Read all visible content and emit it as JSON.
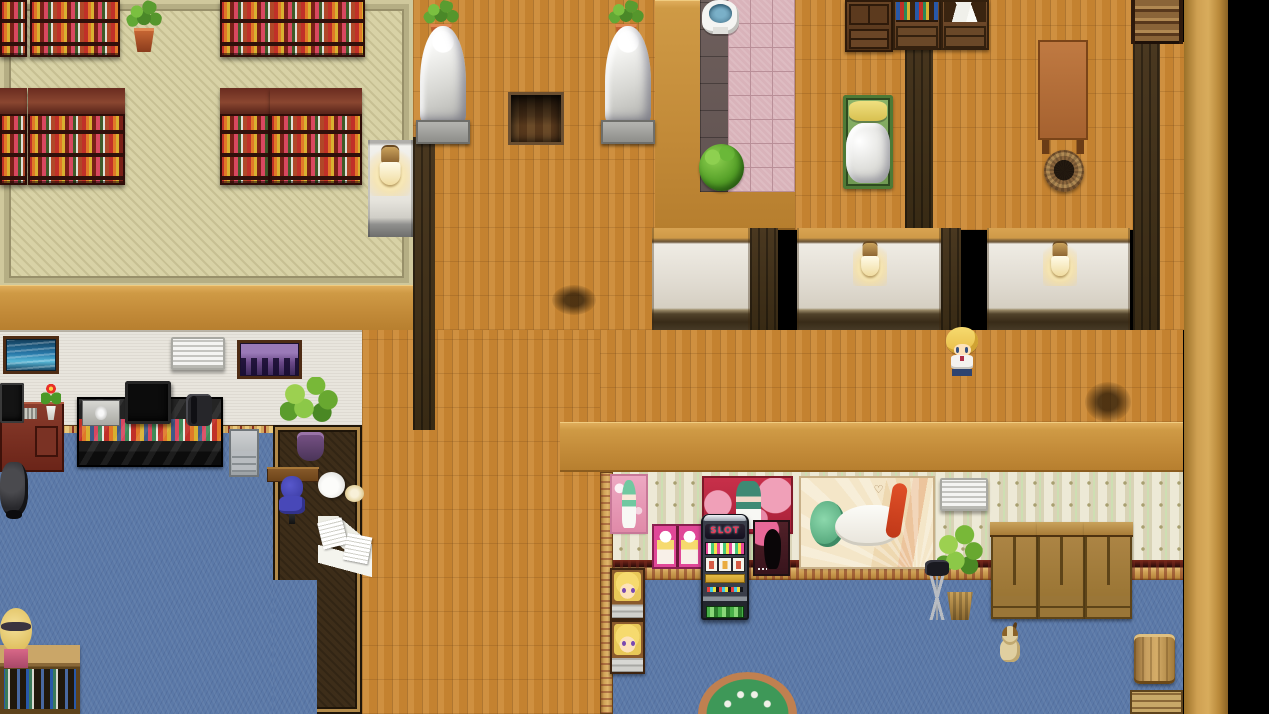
{
  "meta": {
    "width": 1269,
    "height": 714,
    "scene": "rpg-interior-map"
  },
  "labels": {
    "slot_machine": "SLOT",
    "love_poster": "Love"
  },
  "palette": {
    "wood_floor": "#c8883a",
    "tatami": "#d8d2a6",
    "tan_wall": "#c9953f",
    "dark_wall_shadow": "#3f2e1a",
    "office_wall": "#e8e5dd",
    "carpet_blue": "#5b79a8",
    "wallpaper": "#e6e1c8",
    "gold_trim": "#cfa156",
    "lounge_floor": "#3d2d19",
    "pink_path": "#d9b3ba",
    "dark_stone": "#6e5f5c",
    "statue_white": "#e8e8e4",
    "poster_red": "#c8304a",
    "poster_pink": "#e04898",
    "slot_text_red": "#f03858",
    "void": "#000000"
  },
  "scene": {
    "regions": [
      {
        "name": "library-floor",
        "type": "tatami",
        "rect": [
          0,
          0,
          413,
          287
        ],
        "interactable": false
      },
      {
        "name": "library-south-wall",
        "type": "tanwall",
        "rect": [
          0,
          285,
          413,
          47
        ],
        "interactable": false
      },
      {
        "name": "office-wall",
        "type": "officewall",
        "rect": [
          0,
          330,
          362,
          95
        ],
        "interactable": false
      },
      {
        "name": "office-wall-trim",
        "type": "bordertrim",
        "rect": [
          0,
          425,
          273,
          9
        ],
        "interactable": false
      },
      {
        "name": "office-carpet",
        "type": "carpet",
        "rect": [
          0,
          433,
          273,
          281
        ],
        "interactable": false
      },
      {
        "name": "lounge-floor",
        "type": "brownfloor",
        "rect": [
          273,
          425,
          89,
          289
        ],
        "interactable": false
      },
      {
        "name": "office-carpet-notch",
        "type": "carpet",
        "rect": [
          273,
          580,
          44,
          134
        ],
        "interactable": false
      },
      {
        "name": "hall-floor-north",
        "type": "wood",
        "rect": [
          413,
          0,
          242,
          330
        ],
        "interactable": false
      },
      {
        "name": "hall-floor-south",
        "type": "wood",
        "rect": [
          362,
          330,
          238,
          384
        ],
        "interactable": false
      },
      {
        "name": "hall-floor-band",
        "type": "wood",
        "rect": [
          600,
          330,
          583,
          92
        ],
        "interactable": false
      },
      {
        "name": "bedroom-floor",
        "type": "wood",
        "rect": [
          795,
          0,
          388,
          230
        ],
        "interactable": false
      },
      {
        "name": "hall-floor-east",
        "type": "wood",
        "rect": [
          1158,
          42,
          26,
          288
        ],
        "interactable": false
      },
      {
        "name": "bath-wall",
        "type": "tanwall",
        "rect": [
          655,
          0,
          140,
          230
        ],
        "interactable": false
      },
      {
        "name": "bath-floor-dark",
        "type": "stonedark",
        "rect": [
          700,
          0,
          28,
          192
        ],
        "interactable": false
      },
      {
        "name": "bath-path-pink",
        "type": "stonepink",
        "rect": [
          728,
          0,
          67,
          192
        ],
        "interactable": false
      },
      {
        "name": "casino-wall-top",
        "type": "tanwall",
        "rect": [
          560,
          422,
          623,
          50
        ],
        "interactable": false
      },
      {
        "name": "casino-wallpaper",
        "type": "wallpaper",
        "rect": [
          612,
          472,
          571,
          95
        ],
        "interactable": false
      },
      {
        "name": "casino-wall-border",
        "type": "casinotrim",
        "rect": [
          612,
          560,
          571,
          20
        ],
        "interactable": false
      },
      {
        "name": "casino-carpet",
        "type": "carpet",
        "rect": [
          612,
          580,
          571,
          134
        ],
        "interactable": false
      },
      {
        "name": "casino-west-wall",
        "type": "goldwall",
        "rect": [
          600,
          472,
          13,
          242
        ],
        "interactable": false
      },
      {
        "name": "east-wall",
        "type": "tanwallv",
        "rect": [
          1184,
          0,
          44,
          714
        ],
        "interactable": false
      },
      {
        "name": "wall-shadow-bedroom",
        "type": "darkwood",
        "rect": [
          905,
          0,
          28,
          230
        ],
        "interactable": false
      },
      {
        "name": "wall-shadow-east",
        "type": "darkwood",
        "rect": [
          1133,
          42,
          27,
          288
        ],
        "interactable": false
      },
      {
        "name": "wall-shadow-hall",
        "type": "darkwood",
        "rect": [
          413,
          137,
          22,
          293
        ],
        "interactable": false
      },
      {
        "name": "wall-shadow-room1",
        "type": "darkwood",
        "rect": [
          750,
          228,
          28,
          102
        ],
        "interactable": false
      },
      {
        "name": "wall-shadow-room2",
        "type": "darkwood",
        "rect": [
          941,
          228,
          20,
          102
        ],
        "interactable": false
      },
      {
        "name": "room-wall-1",
        "type": "panel",
        "rect": [
          652,
          228,
          98,
          102
        ],
        "interactable": false
      },
      {
        "name": "room-wall-2",
        "type": "panel",
        "rect": [
          797,
          228,
          144,
          102
        ],
        "interactable": false
      },
      {
        "name": "room-wall-3",
        "type": "panel",
        "rect": [
          987,
          228,
          143,
          102
        ],
        "interactable": false
      },
      {
        "name": "hall-lamp-wall",
        "type": "lampwall",
        "rect": [
          368,
          140,
          45,
          97
        ],
        "interactable": false
      },
      {
        "name": "floor-stain-1",
        "type": "smudge",
        "rect": [
          1085,
          382,
          46,
          40
        ],
        "interactable": false
      },
      {
        "name": "floor-stain-2",
        "type": "smudge",
        "rect": [
          552,
          285,
          44,
          30
        ],
        "interactable": false
      }
    ],
    "entities": [
      {
        "name": "library-bookshelf-1",
        "type": "shelftop",
        "rect": [
          0,
          0,
          27,
          57
        ],
        "interactable": false
      },
      {
        "name": "library-bookshelf-2",
        "type": "shelftop",
        "rect": [
          30,
          0,
          90,
          57
        ],
        "interactable": false
      },
      {
        "name": "library-plant",
        "type": "plantpot",
        "rect": [
          124,
          0,
          40,
          52
        ],
        "interactable": false
      },
      {
        "name": "library-bookshelf-3",
        "type": "shelftop",
        "rect": [
          220,
          0,
          145,
          57
        ],
        "interactable": false
      },
      {
        "name": "library-bookshelf-4",
        "type": "bookshelf",
        "rect": [
          0,
          88,
          27,
          97
        ],
        "interactable": false
      },
      {
        "name": "library-bookshelf-5",
        "type": "bookshelf",
        "rect": [
          28,
          88,
          97,
          97
        ],
        "interactable": false
      },
      {
        "name": "library-bookshelf-6",
        "type": "bookshelf",
        "rect": [
          220,
          88,
          50,
          97
        ],
        "interactable": false
      },
      {
        "name": "library-bookshelf-7",
        "type": "bookshelf",
        "rect": [
          270,
          88,
          92,
          97
        ],
        "interactable": false
      },
      {
        "name": "hall-lamp",
        "type": "lamp",
        "rect": [
          370,
          144,
          40,
          52
        ],
        "interactable": false
      },
      {
        "name": "statue-plant-1",
        "type": "plantpot",
        "rect": [
          420,
          0,
          42,
          44
        ],
        "interactable": false
      },
      {
        "name": "statue-1",
        "type": "statue",
        "rect": [
          412,
          26,
          62,
          118
        ],
        "interactable": false
      },
      {
        "name": "statue-plant-2",
        "type": "plantpot",
        "rect": [
          605,
          0,
          42,
          44
        ],
        "interactable": false
      },
      {
        "name": "statue-2",
        "type": "statue",
        "rect": [
          597,
          26,
          62,
          118
        ],
        "interactable": false
      },
      {
        "name": "floor-hatch",
        "type": "trapdoor",
        "rect": [
          508,
          92,
          50,
          47
        ],
        "interactable": true
      },
      {
        "name": "toilet",
        "type": "toilet",
        "rect": [
          702,
          0,
          37,
          34
        ],
        "interactable": true
      },
      {
        "name": "bath-bush",
        "type": "bush",
        "rect": [
          699,
          144,
          45,
          47
        ],
        "interactable": false
      },
      {
        "name": "bedroom-cabinet",
        "type": "cabinet",
        "rect": [
          845,
          0,
          48,
          52
        ],
        "interactable": false
      },
      {
        "name": "bedroom-dresser-books",
        "type": "dresserbooks",
        "rect": [
          893,
          0,
          48,
          50
        ],
        "interactable": false
      },
      {
        "name": "bedroom-dresser-papers",
        "type": "dresserpapers",
        "rect": [
          941,
          0,
          48,
          50
        ],
        "interactable": false
      },
      {
        "name": "bed",
        "type": "bed",
        "rect": [
          843,
          95,
          50,
          94
        ],
        "interactable": true
      },
      {
        "name": "bedroom-table",
        "type": "tablebrown",
        "rect": [
          1038,
          40,
          50,
          114
        ],
        "interactable": false
      },
      {
        "name": "bedroom-basket",
        "type": "basket",
        "rect": [
          1044,
          150,
          40,
          42
        ],
        "interactable": false
      },
      {
        "name": "stairs-down",
        "type": "stairs",
        "rect": [
          1131,
          0,
          52,
          44
        ],
        "interactable": true
      },
      {
        "name": "room-lamp-1",
        "type": "lamp",
        "rect": [
          853,
          240,
          34,
          46
        ],
        "interactable": false
      },
      {
        "name": "room-lamp-2",
        "type": "lamp",
        "rect": [
          1043,
          240,
          34,
          46
        ],
        "interactable": false
      },
      {
        "name": "picture-ocean",
        "type": "picocean",
        "rect": [
          6,
          339,
          50,
          32
        ],
        "interactable": false
      },
      {
        "name": "office-ac-vent",
        "type": "acvent",
        "rect": [
          171,
          337,
          54,
          33
        ],
        "interactable": false
      },
      {
        "name": "picture-city",
        "type": "piccity",
        "rect": [
          240,
          343,
          59,
          33
        ],
        "interactable": false
      },
      {
        "name": "office-desk",
        "type": "deskred",
        "rect": [
          0,
          402,
          64,
          70
        ],
        "interactable": false
      },
      {
        "name": "office-monitor",
        "type": "monitor",
        "rect": [
          0,
          383,
          24,
          40
        ],
        "interactable": false
      },
      {
        "name": "desk-flower",
        "type": "flowerpot",
        "rect": [
          40,
          382,
          22,
          38
        ],
        "interactable": false
      },
      {
        "name": "media-console",
        "type": "mediaconsole",
        "rect": [
          77,
          397,
          146,
          70
        ],
        "interactable": false
      },
      {
        "name": "dvd-player",
        "type": "dvd",
        "rect": [
          82,
          400,
          38,
          26
        ],
        "interactable": false
      },
      {
        "name": "tv-monitor",
        "type": "tv",
        "rect": [
          125,
          381,
          46,
          43
        ],
        "interactable": false
      },
      {
        "name": "office-phone",
        "type": "phone",
        "rect": [
          186,
          394,
          26,
          32
        ],
        "interactable": false
      },
      {
        "name": "printer",
        "type": "printer",
        "rect": [
          229,
          429,
          30,
          48
        ],
        "interactable": false
      },
      {
        "name": "side-counter",
        "type": "counterwood",
        "rect": [
          267,
          467,
          52,
          15
        ],
        "interactable": false
      },
      {
        "name": "office-chair-blue",
        "type": "chairblue",
        "rect": [
          276,
          476,
          32,
          50
        ],
        "interactable": true
      },
      {
        "name": "lounge-plant",
        "type": "plantbig",
        "rect": [
          280,
          377,
          60,
          84
        ],
        "interactable": false
      },
      {
        "name": "tea-set",
        "type": "teaset",
        "rect": [
          315,
          469,
          50,
          36
        ],
        "interactable": false
      },
      {
        "name": "scattered-papers",
        "type": "papers",
        "rect": [
          318,
          516,
          54,
          64
        ],
        "interactable": false
      },
      {
        "name": "office-chair-black",
        "type": "chairblack",
        "rect": [
          0,
          462,
          28,
          54
        ],
        "interactable": true
      },
      {
        "name": "video-shelf",
        "type": "shelfoak",
        "rect": [
          0,
          645,
          80,
          69
        ],
        "interactable": false
      },
      {
        "name": "npc-receptionist",
        "type": "npcgirl",
        "rect": [
          0,
          606,
          32,
          62
        ],
        "interactable": true
      },
      {
        "name": "poster-pinup-small",
        "type": "postersmall",
        "rect": [
          612,
          476,
          34,
          56
        ],
        "interactable": false
      },
      {
        "name": "poster-love",
        "type": "posterlove",
        "rect": [
          704,
          478,
          87,
          54
        ],
        "interactable": false
      },
      {
        "name": "poster-pink-pair",
        "type": "posterpair",
        "rect": [
          654,
          526,
          47,
          41
        ],
        "interactable": false
      },
      {
        "name": "poster-silhouette",
        "type": "postersil",
        "rect": [
          755,
          522,
          33,
          52
        ],
        "interactable": false
      },
      {
        "name": "poster-pinup-large",
        "type": "posterlying",
        "rect": [
          801,
          478,
          132,
          89
        ],
        "interactable": false
      },
      {
        "name": "casino-ac-vent",
        "type": "acvent",
        "rect": [
          940,
          478,
          48,
          33
        ],
        "interactable": false
      },
      {
        "name": "slot-machine",
        "type": "slot",
        "rect": [
          701,
          514,
          48,
          106
        ],
        "interactable": true
      },
      {
        "name": "casino-plant",
        "type": "plantwoven",
        "rect": [
          937,
          525,
          46,
          95
        ],
        "interactable": false
      },
      {
        "name": "camera-tripod",
        "type": "tripod",
        "rect": [
          907,
          560,
          60,
          60
        ],
        "interactable": true
      },
      {
        "name": "photo-machine-1",
        "type": "portraitmachine",
        "rect": [
          610,
          568,
          35,
          52
        ],
        "interactable": true
      },
      {
        "name": "photo-machine-2",
        "type": "portraitmachine",
        "rect": [
          610,
          620,
          35,
          54
        ],
        "interactable": true
      },
      {
        "name": "wardrobe-1",
        "type": "wardrobe",
        "rect": [
          991,
          522,
          47,
          97
        ],
        "interactable": false
      },
      {
        "name": "wardrobe-2",
        "type": "wardrobe",
        "rect": [
          1038,
          522,
          47,
          97
        ],
        "interactable": false
      },
      {
        "name": "wardrobe-3",
        "type": "wardrobe",
        "rect": [
          1085,
          522,
          47,
          97
        ],
        "interactable": false
      },
      {
        "name": "puppy",
        "type": "dog",
        "rect": [
          996,
          624,
          28,
          40
        ],
        "interactable": true
      },
      {
        "name": "barrel",
        "type": "barrel",
        "rect": [
          1134,
          634,
          41,
          50
        ],
        "interactable": false
      },
      {
        "name": "crate",
        "type": "crate",
        "rect": [
          1130,
          690,
          53,
          24
        ],
        "interactable": false
      },
      {
        "name": "poker-table",
        "type": "pokertable",
        "rect": [
          698,
          672,
          99,
          42
        ],
        "interactable": true
      },
      {
        "name": "player-character",
        "type": "player",
        "rect": [
          945,
          327,
          34,
          50
        ],
        "interactable": true
      }
    ]
  }
}
